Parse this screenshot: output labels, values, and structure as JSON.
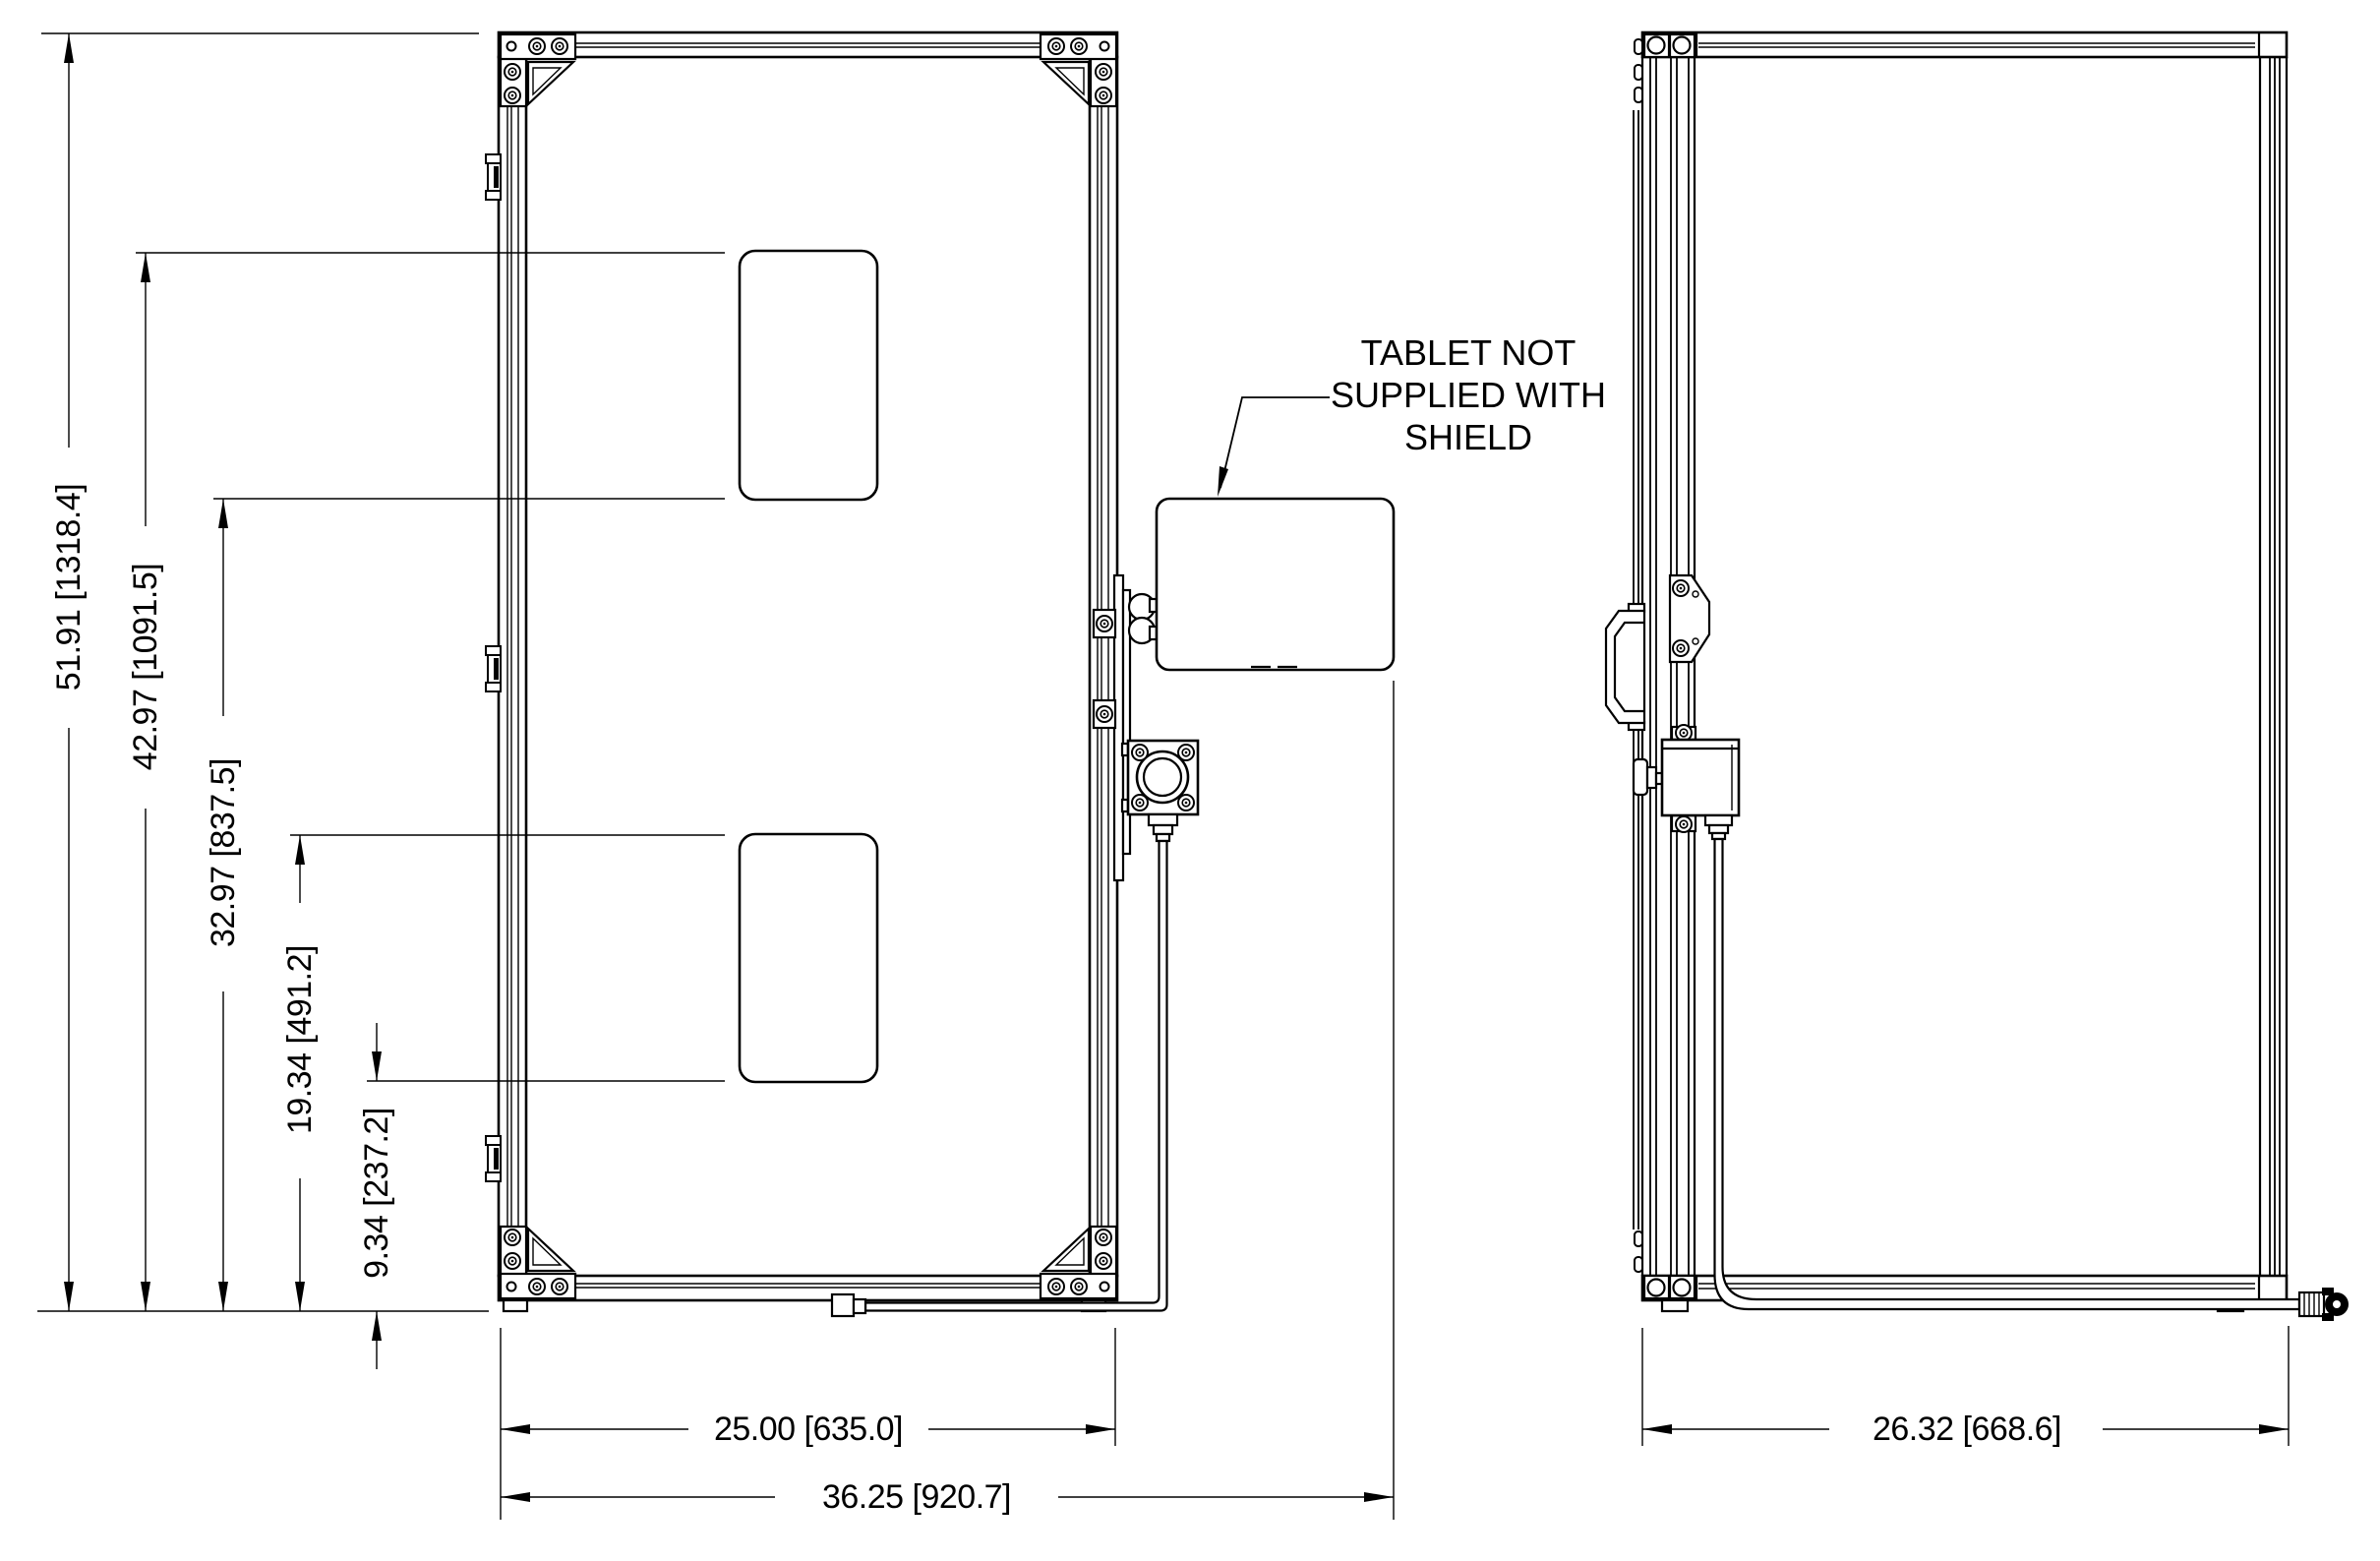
{
  "drawing": {
    "type": "engineering-dimension-drawing",
    "views": [
      "front-view-of-shield-frame",
      "side-view-of-shield-frame"
    ],
    "background_color": "#ffffff",
    "line_color": "#000000"
  },
  "note": {
    "line1": "TABLET NOT",
    "line2": "SUPPLIED WITH",
    "line3": "SHIELD"
  },
  "dimensions": {
    "v_total": "51.91 [1318.4]",
    "v_upper_window_top": "42.97 [1091.5]",
    "v_upper_window_bottom": "32.97 [837.5]",
    "v_lower_window_top": "19.34 [491.2]",
    "v_lower_window_bottom": "9.34 [237.2]",
    "h_frame_width": "25.00 [635.0]",
    "h_overall_width": "36.25 [920.7]",
    "h_side_depth": "26.32 [668.6]"
  }
}
